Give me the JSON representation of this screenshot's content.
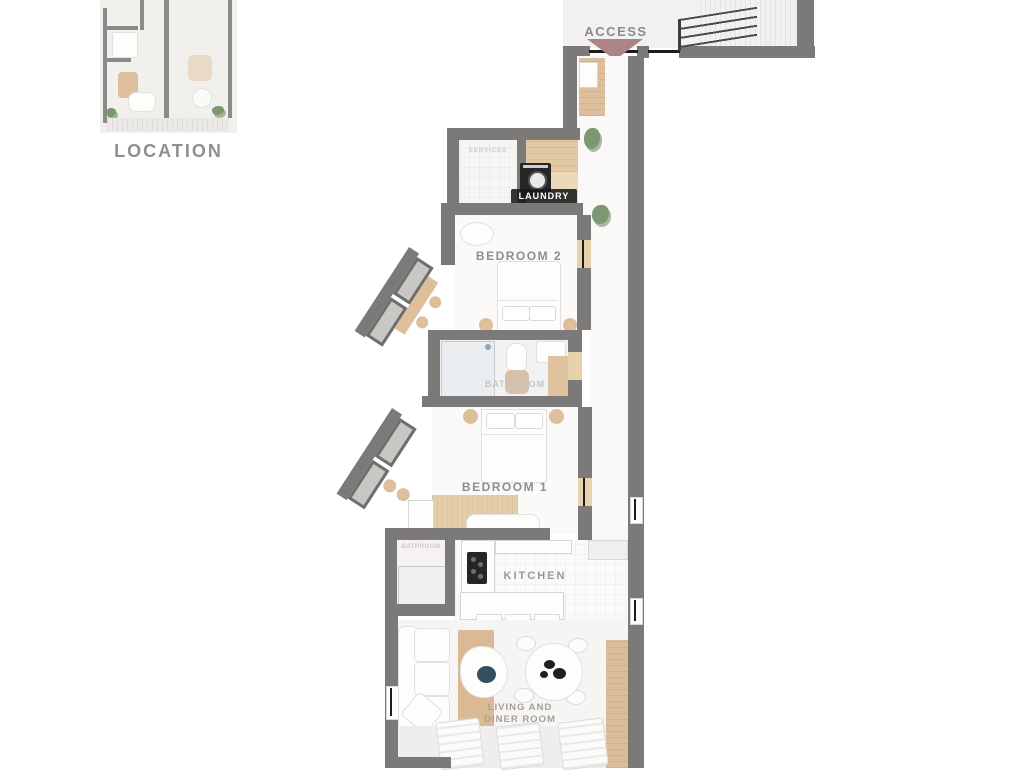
{
  "location_panel": {
    "label": "LOCATION"
  },
  "plan": {
    "access_label": "ACCESS",
    "rooms": {
      "services": "SERVICES",
      "laundry": "LAUNDRY",
      "bedroom2": "BEDROOM 2",
      "bathroom_main": "BATHROOM",
      "bedroom1": "BEDROOM 1",
      "bathroom_small": "BATHROOM",
      "kitchen": "KITCHEN",
      "living_line1": "LIVING AND",
      "living_line2": "DINER ROOM"
    },
    "colors": {
      "wall": "#7b7a78",
      "floor": "#f7f6f4",
      "wood": "#ddbf9c",
      "access_arrow": "#ac8487",
      "label": "#949290",
      "dark": "#262626",
      "plant": "#7d9770",
      "bowl_teal": "#35505c"
    }
  }
}
